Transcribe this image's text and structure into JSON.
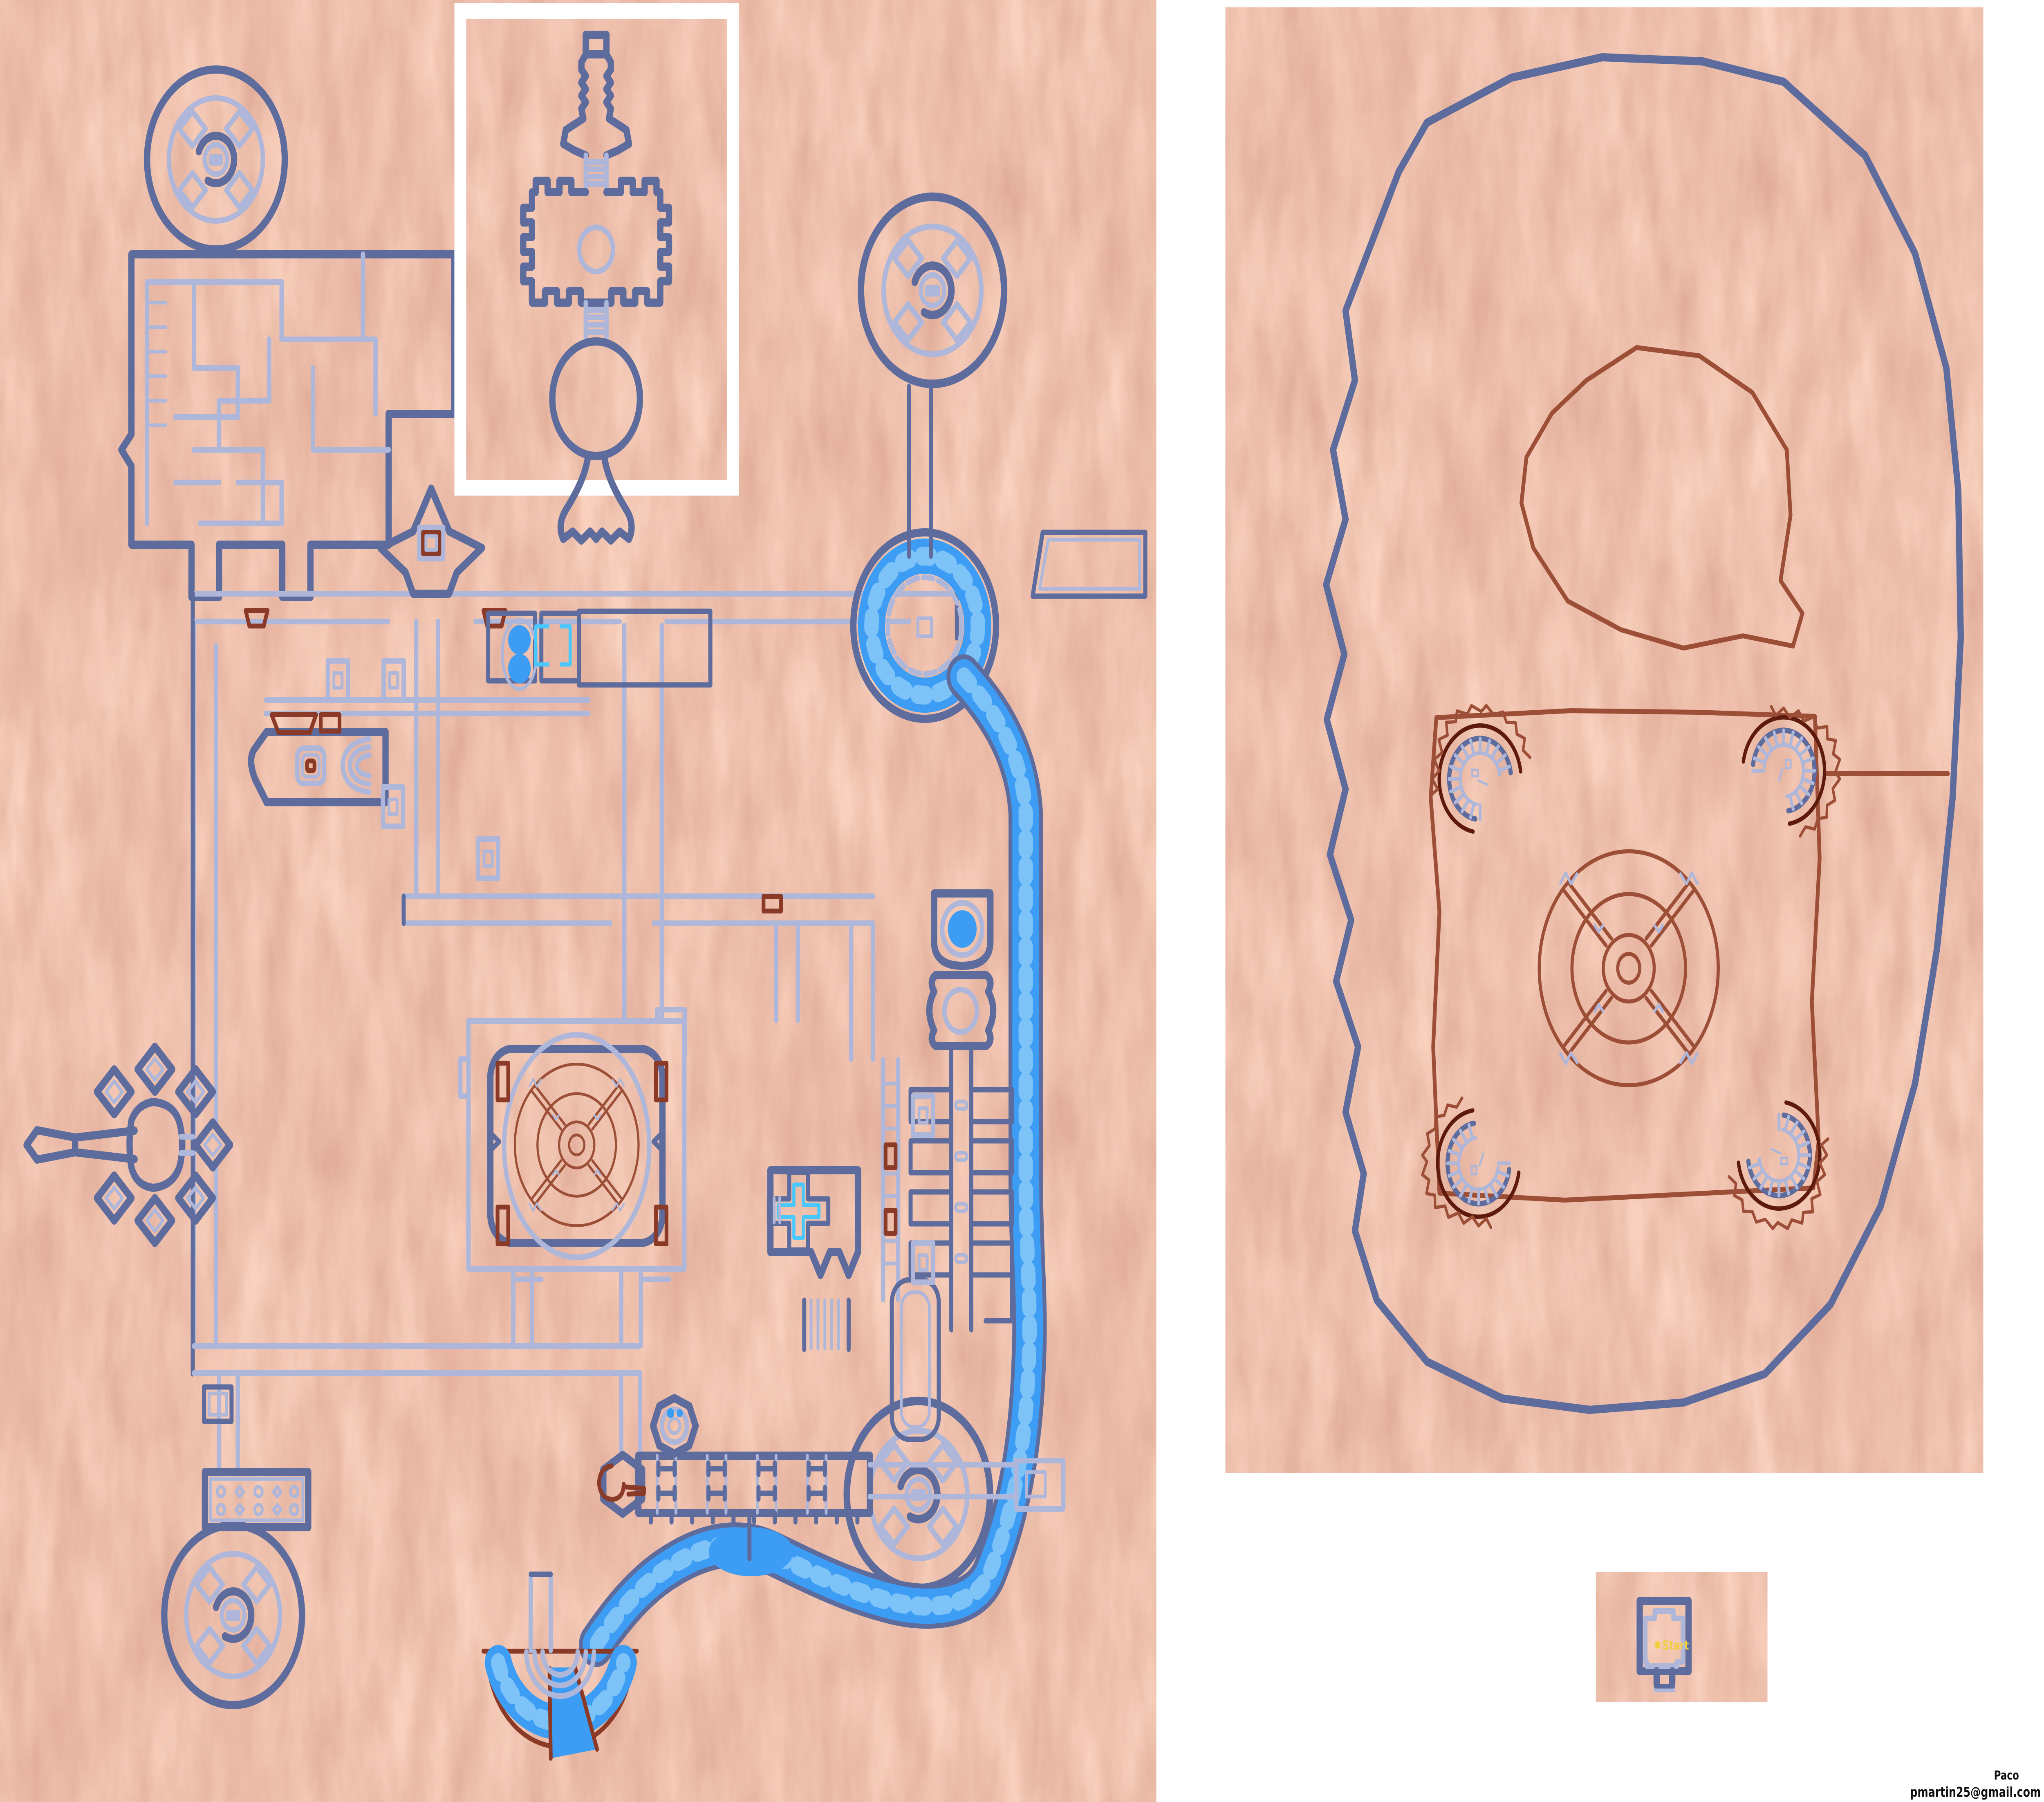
{
  "credit": {
    "author": "Paco",
    "email": "pmartin25@gmail.com"
  },
  "start_room": {
    "marker": "dot",
    "label": "Start"
  },
  "panels": {
    "fortress_map": "large textured fortress level map with river",
    "inset_detail": "white-framed totem detail map",
    "region_map": "arena region map with four corner towers and central mandala",
    "start_panel": "small start-room map"
  },
  "colors": {
    "page_bg": "#ffffff",
    "ground_terracotta": "#e19173",
    "ground_dark_patch": "#b85a44",
    "wall_dark_blue": "#5d6b9d",
    "wall_light_blue": "#aeb7d9",
    "water_blue": "#3d9df4",
    "water_light_blue": "#8fcdf9",
    "detail_brown": "#8a3a26",
    "detail_dark_maroon": "#5e1a0c",
    "region_line_brown": "#9c4e36",
    "start_label_yellow": "#f2cd3d"
  }
}
